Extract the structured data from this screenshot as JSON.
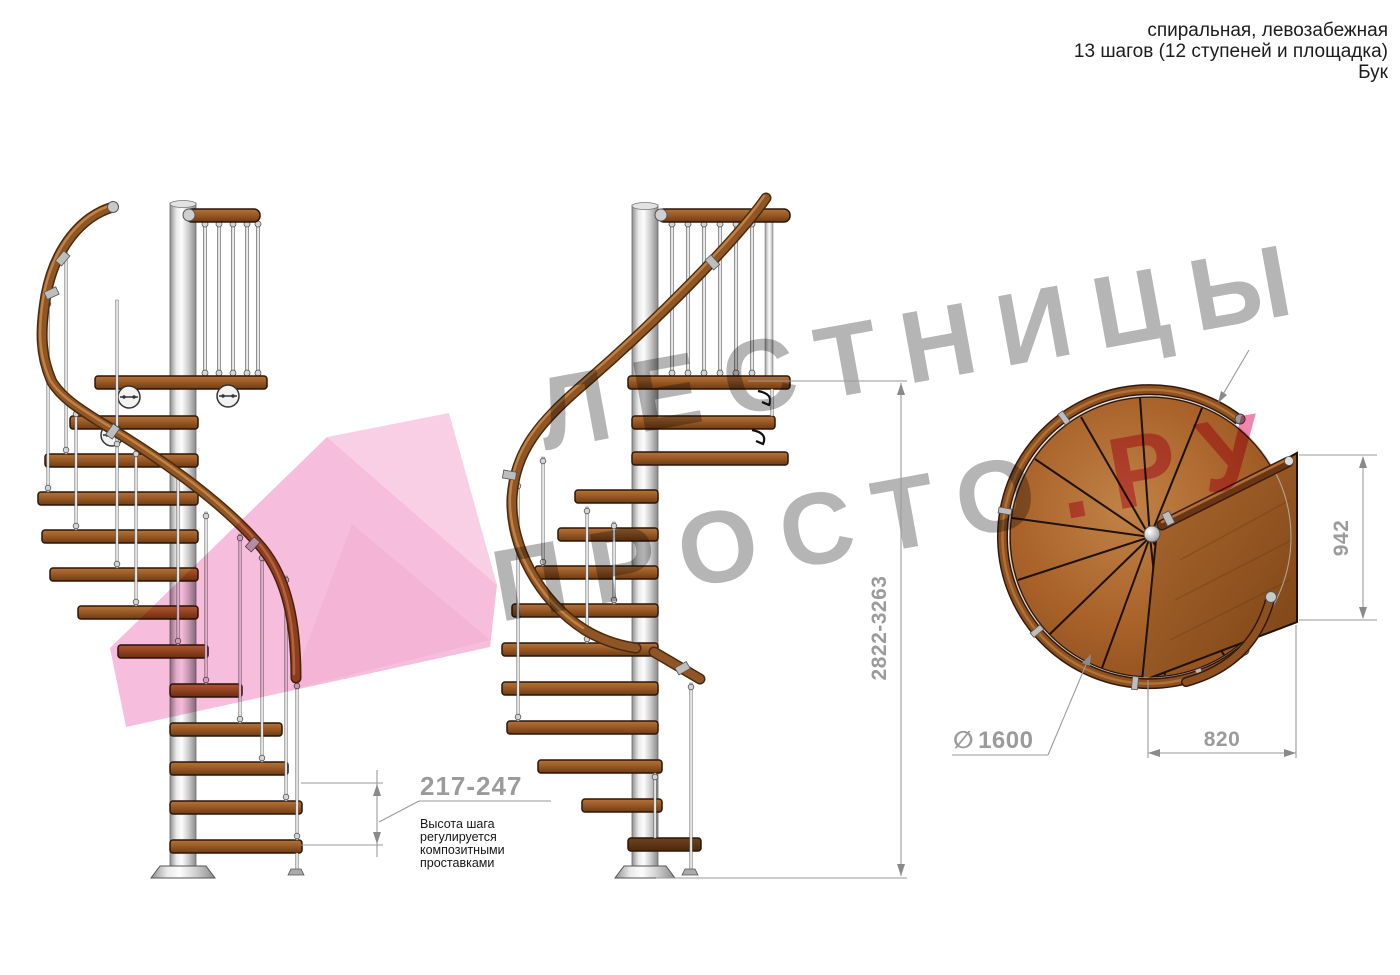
{
  "header": {
    "lines": [
      "спиральная, левозабежная",
      "13 шагов (12 ступеней и площадка)",
      "Бук"
    ]
  },
  "watermark": {
    "brand_top": "ЛЕСТНИЦЫ",
    "brand_bottom_gray": "ПРОСТО",
    "brand_bottom_pink": ".РУ",
    "text_gray_color": "#a8a8a8",
    "text_pink_color": "#ee6f9f",
    "arrow_pink_color": "#f5b1d7"
  },
  "dimensions": {
    "total_height": {
      "value": "2822-3263"
    },
    "step_height": {
      "value": "217-247",
      "note_lines": [
        "Высота шага",
        "регулируется",
        "композитными",
        "проставками"
      ]
    },
    "platform_height": {
      "value": "942"
    },
    "platform_width": {
      "value": "820"
    },
    "diameter": {
      "symbol": "∅",
      "value": "1600"
    }
  },
  "colors": {
    "wood_mid": "#9a5a26",
    "wood_dark": "#6f3c12",
    "wood_light": "#b5743a",
    "metal": "#d9d9d9",
    "dim_gray": "#9b9b9b",
    "text_black": "#1c1c1c"
  }
}
